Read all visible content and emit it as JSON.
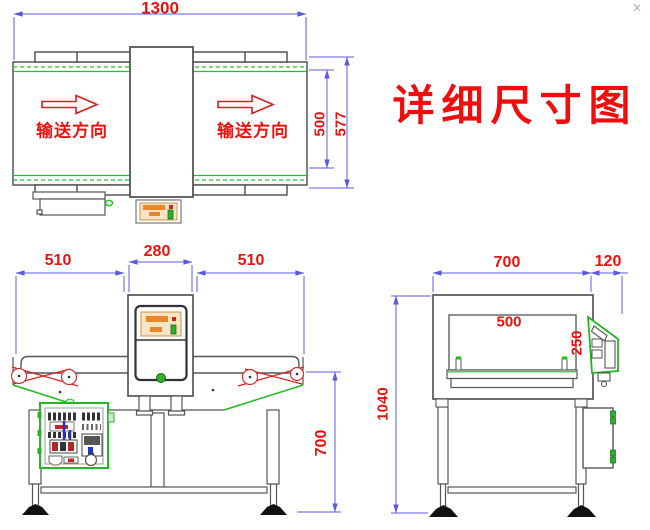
{
  "title": "详细尺寸图",
  "top_view": {
    "dim_total_length": "1300",
    "dim_belt_width": "500",
    "dim_frame_width": "577",
    "direction_left": "输送方向",
    "direction_right": "输送方向"
  },
  "front_view": {
    "dim_left_section": "510",
    "dim_detector_width": "280",
    "dim_right_section": "510",
    "dim_belt_height": "700"
  },
  "side_view": {
    "dim_machine_depth": "700",
    "dim_panel_depth": "120",
    "dim_aperture_width": "500",
    "dim_aperture_height": "250",
    "dim_total_height": "1040"
  },
  "colors": {
    "dimension_line": "#5b5be0",
    "dimension_text": "#e8120f",
    "drawing_line": "#555555",
    "highlight_green": "#22b822",
    "belt_red": "#d42020",
    "panel_orange": "#e8862a",
    "panel_tan": "#f8e3c4"
  }
}
